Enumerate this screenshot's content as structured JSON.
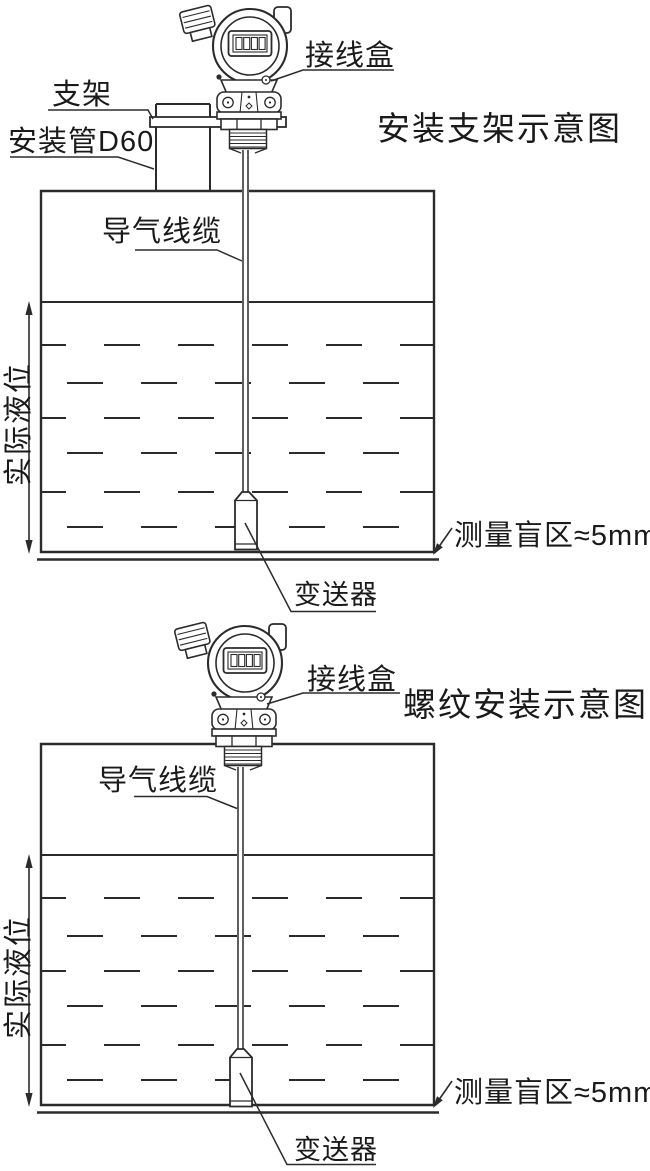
{
  "colors": {
    "background": "#ffffff",
    "line": "#2b2b2b",
    "text": "#1a1a1a"
  },
  "diagram_top": {
    "title": "安装支架示意图",
    "labels": {
      "bracket": "支架",
      "mounting_pipe": "安装管D60",
      "junction_box": "接线盒",
      "air_cable": "导气线缆",
      "actual_level": "实际液位",
      "blind_zone": "测量盲区≈5mm",
      "transmitter": "变送器"
    }
  },
  "diagram_bottom": {
    "title": "螺纹安装示意图",
    "labels": {
      "junction_box": "接线盒",
      "air_cable": "导气线缆",
      "actual_level": "实际液位",
      "blind_zone": "测量盲区≈5mm",
      "transmitter": "变送器"
    }
  }
}
